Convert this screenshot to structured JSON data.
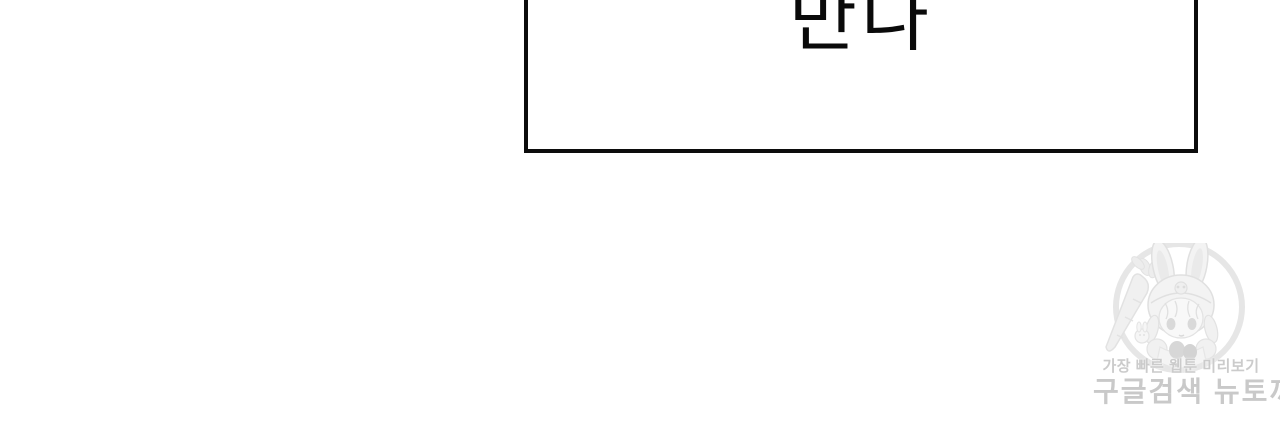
{
  "panel": {
    "text": "만나"
  },
  "watermark": {
    "tagline": "가장 빠른 웹툰 미리보기",
    "site_text": "구글검색 뉴토끼",
    "mascot_icon": "bunny-hood-girl-with-carrot-icon",
    "colors": {
      "text": "#c9c9c9",
      "illustration": "#e4e4e4"
    }
  },
  "colors": {
    "background": "#ffffff",
    "panel_border": "#0c0c0c"
  }
}
